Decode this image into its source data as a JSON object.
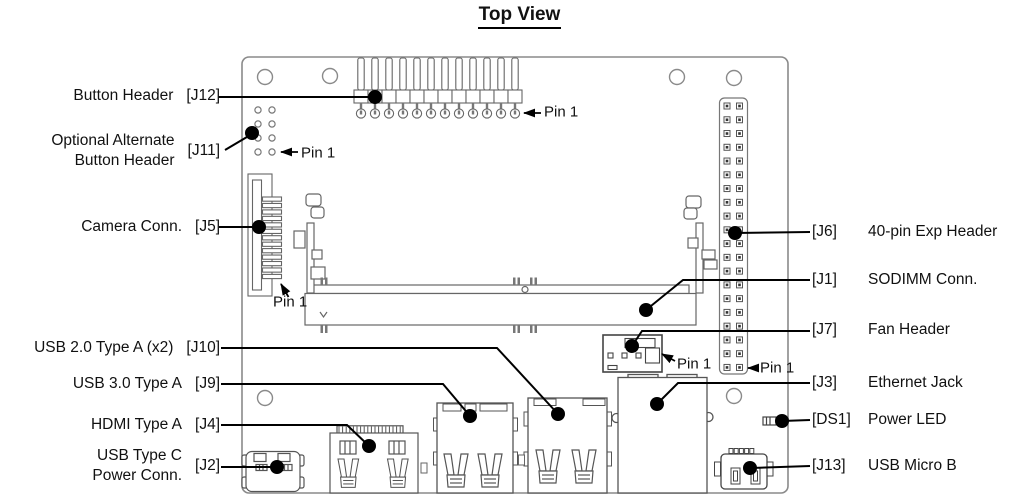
{
  "title": "Top View",
  "pin1": "Pin 1",
  "left_labels": [
    {
      "name": "Button Header",
      "ref": "[J12]"
    },
    {
      "name1": "Optional Alternate",
      "name2": "Button Header",
      "ref": "[J11]"
    },
    {
      "name": "Camera Conn.",
      "ref": "[J5]"
    },
    {
      "name": "USB 2.0 Type A (x2)",
      "ref": "[J10]"
    },
    {
      "name": "USB 3.0 Type A",
      "ref": "[J9]"
    },
    {
      "name": "HDMI Type A",
      "ref": "[J4]"
    },
    {
      "name1": "USB Type C",
      "name2": "Power Conn.",
      "ref": "[J2]"
    }
  ],
  "right_labels": [
    {
      "ref": "[J6]",
      "name": "40-pin Exp Header"
    },
    {
      "ref": "[J1]",
      "name": "SODIMM Conn."
    },
    {
      "ref": "[J7]",
      "name": "Fan Header"
    },
    {
      "ref": "[J3]",
      "name": "Ethernet Jack"
    },
    {
      "ref": "[DS1]",
      "name": "Power LED"
    },
    {
      "ref": "[J13]",
      "name": "USB Micro B"
    }
  ],
  "colors": {
    "leader_line": "#000000",
    "board_outline": "#8a8a8a",
    "connector_outline": "#5a5a5a"
  }
}
